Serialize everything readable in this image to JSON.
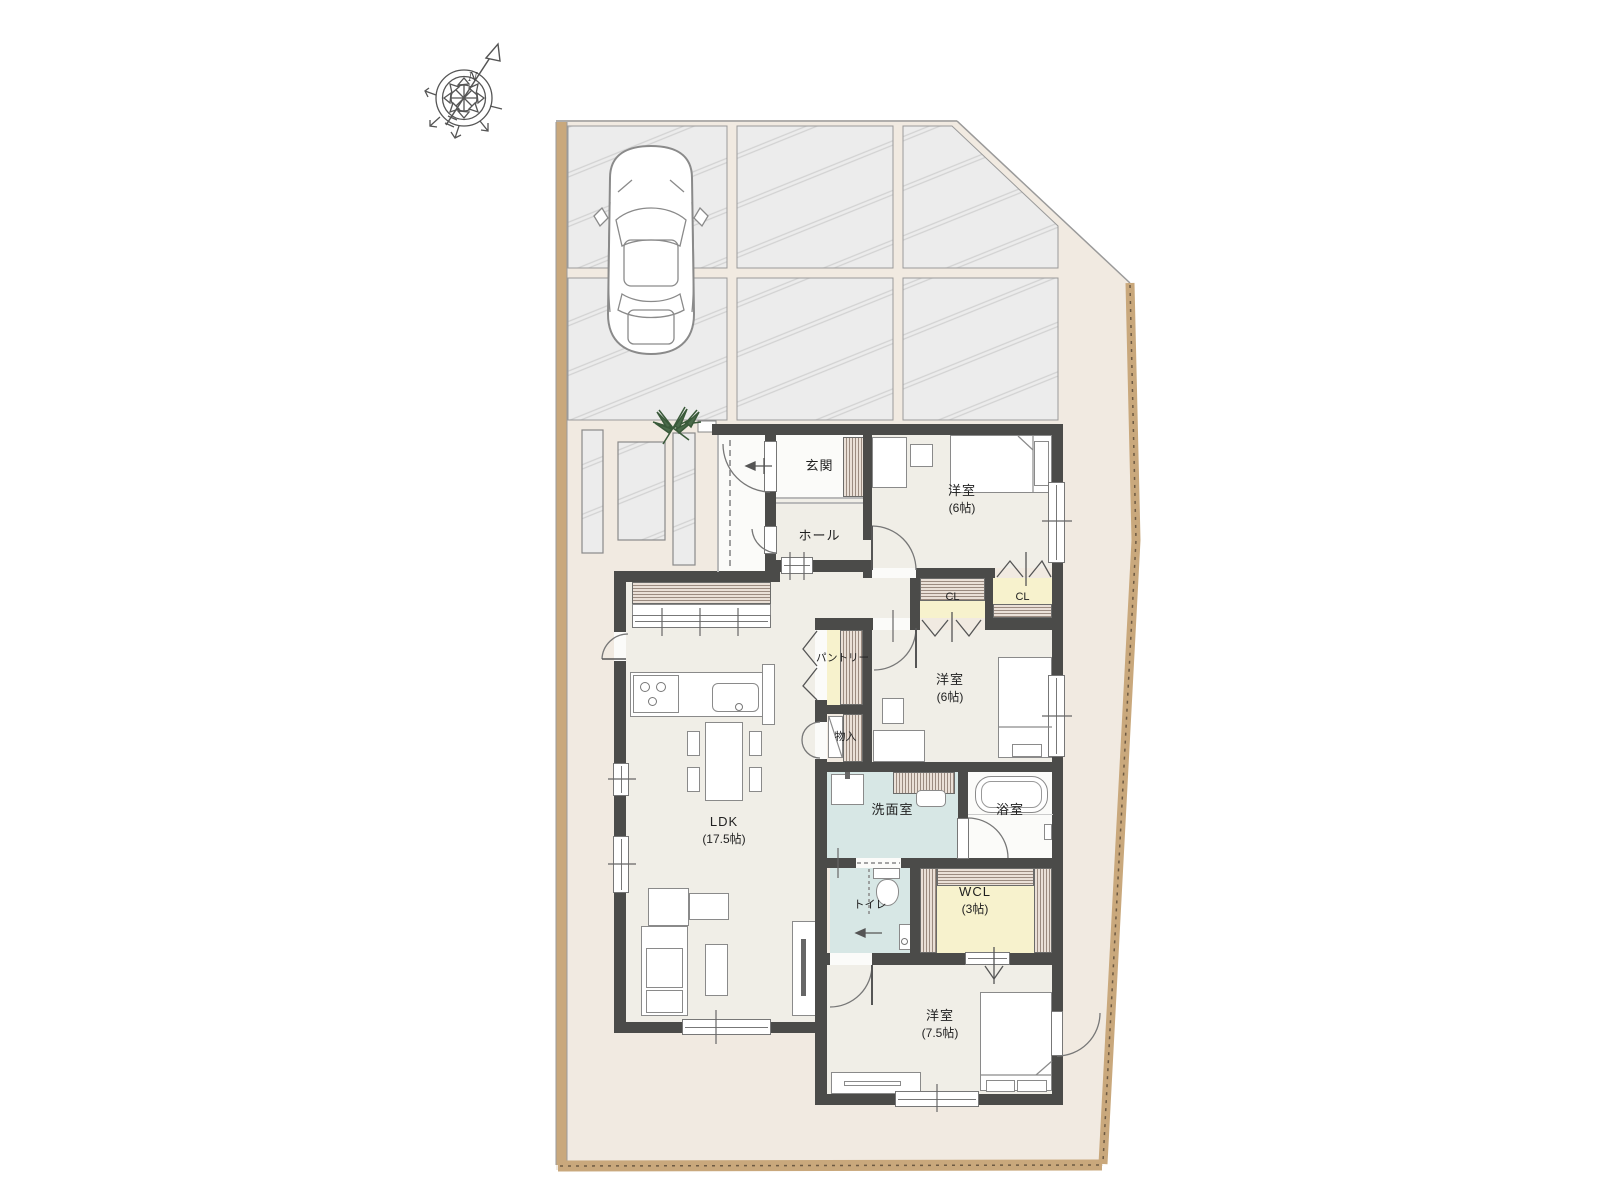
{
  "compass": {
    "north_label": "N"
  },
  "colors": {
    "wall": "#4b4b49",
    "room-floor": "#f0eee7",
    "entry-floor": "#fbfbf9",
    "closet-yellow": "#f7f2cd",
    "water-blue": "#d7e7e5",
    "lot-beige": "#f1eae1",
    "boundary-tan": "#c9a87c",
    "driveway-gray": "#ececec",
    "shelf-hatch-brown": "#9b8b80"
  },
  "rooms": {
    "genkan": {
      "label": "玄関"
    },
    "hall": {
      "label": "ホール"
    },
    "bedroom1": {
      "label": "洋室",
      "size": "(6帖)"
    },
    "bedroom2": {
      "label": "洋室",
      "size": "(6帖)"
    },
    "bedroom3": {
      "label": "洋室",
      "size": "(7.5帖)"
    },
    "ldk": {
      "label": "LDK",
      "size": "(17.5帖)"
    },
    "pantry": {
      "label": "パントリー"
    },
    "storage": {
      "label": "物入"
    },
    "washroom": {
      "label": "洗面室"
    },
    "bathroom": {
      "label": "浴室"
    },
    "toilet": {
      "label": "トイレ"
    },
    "wcl": {
      "label": "WCL",
      "size": "(3帖)"
    },
    "closet_left": {
      "label": "CL"
    },
    "closet_right": {
      "label": "CL"
    }
  }
}
